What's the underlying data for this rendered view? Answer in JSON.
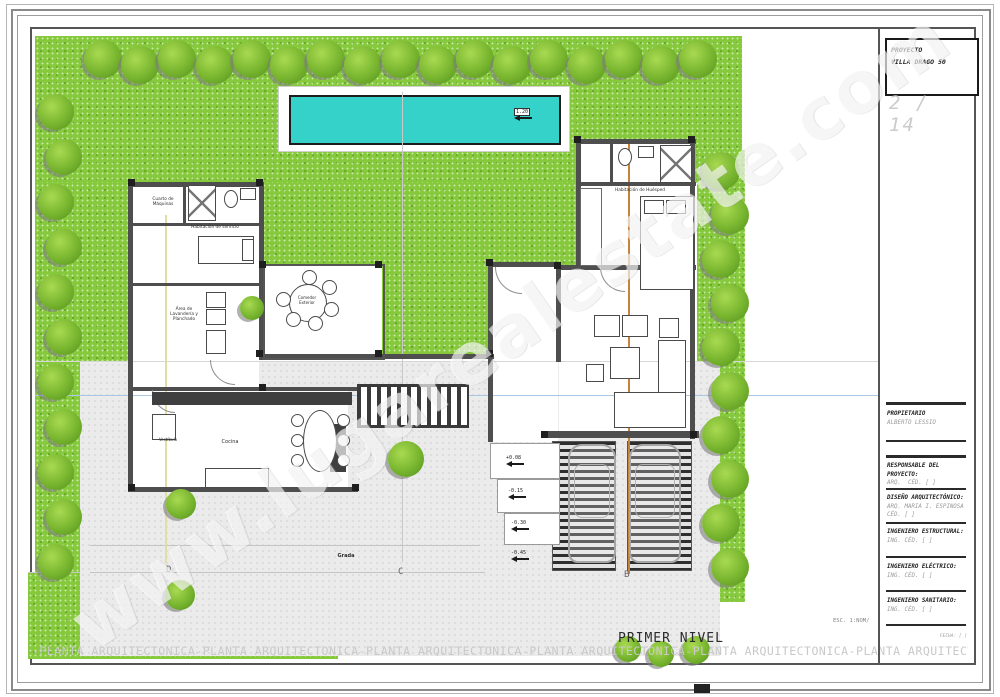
{
  "watermark": {
    "text": "www.lugarealestate.com"
  },
  "title_block": {
    "proyecto_label": "PROYECTO",
    "proyecto_name": "VILLA DRAGO 50",
    "sheet_number": "2 / 14",
    "propietario_label": "PROPIETARIO",
    "propietario_name": "ALBERTO LESSIO",
    "sections": [
      {
        "title": "RESPONSABLE DEL PROYECTO:",
        "line1": "ARQ.",
        "line2": "CÉD. [ ]"
      },
      {
        "title": "DISEÑO ARQUITECTÓNICO:",
        "line1": "ARQ. MARIA I. ESPINOSA",
        "line2": "CÉD. [ ]"
      },
      {
        "title": "INGENIERO ESTRUCTURAL:",
        "line1": "ING.",
        "line2": "CÉD. [ ]"
      },
      {
        "title": "INGENIERO ELÉCTRICO:",
        "line1": "ING.",
        "line2": "CÉD. [ ]"
      },
      {
        "title": "INGENIERO SANITARIO:",
        "line1": "ING.",
        "line2": "CÉD. [ ]"
      }
    ],
    "escala": "ESC. 1:NOM/",
    "fecha": "FECHA: [ ]"
  },
  "plan": {
    "sheet_title": "PRIMER NIVEL",
    "rooms": [
      {
        "label": "Cuarto de Máquinas"
      },
      {
        "label": "Habitación de servicio"
      },
      {
        "label": "Área de Lavandería y Planchado"
      },
      {
        "label": "Comedor Exterior"
      },
      {
        "label": "Cocina"
      },
      {
        "label": "Vestíbulo"
      },
      {
        "label": "Habitación de Huésped"
      },
      {
        "label": "Grada"
      }
    ],
    "grid_letters": [
      "D",
      "C",
      "B"
    ],
    "level_markers": [
      "+0.08",
      "-0.15",
      "-0.30",
      "-0.45"
    ],
    "pool_marker": "1.20"
  },
  "footer": {
    "banner": "-PLANTA ARQUITECTONICA-PLANTA ARQUITECTONICA-PLANTA ARQUITECTONICA-PLANTA ARQUITECTONICA-PLANTA ARQUITECTONICA-PLANTA ARQUITECTONICA-PLANTA ARQUITECTONICA"
  },
  "colors": {
    "grass": "#86c93c",
    "pool": "#35d2ca",
    "wall": "#4e4e4e",
    "section_line": "#c8823a"
  }
}
